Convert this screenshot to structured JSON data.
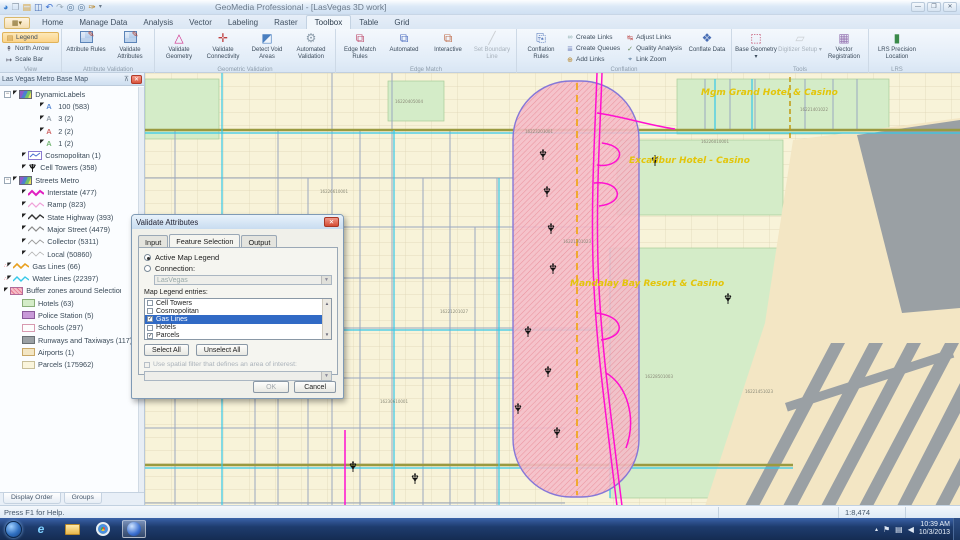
{
  "window": {
    "title": "GeoMedia Professional - [LasVegas 3D work]"
  },
  "ribbon": {
    "tabs": [
      "Home",
      "Manage Data",
      "Analysis",
      "Vector",
      "Labeling",
      "Raster",
      "Toolbox",
      "Table",
      "Grid"
    ],
    "active_tab": "Toolbox",
    "view": {
      "label": "View",
      "buttons": [
        "Legend",
        "North Arrow",
        "Scale Bar"
      ]
    },
    "attr_validation": {
      "label": "Attribute Validation",
      "buttons": [
        "Attribute Rules",
        "Validate Attributes"
      ]
    },
    "geom_validation": {
      "label": "Geometric Validation",
      "buttons": [
        "Validate Geometry",
        "Validate Connectivity",
        "Detect Void Areas",
        "Automated Validation"
      ]
    },
    "edge_match": {
      "label": "Edge Match",
      "buttons": [
        "Edge Match Rules",
        "Automated",
        "Interactive",
        "Set Boundary Line"
      ]
    },
    "conflation": {
      "label": "Conflation",
      "large": "Conflation Rules",
      "small": [
        "Create Links",
        "Create Queues",
        "Add Links",
        "Adjust Links",
        "Quality Analysis",
        "Link Zoom"
      ],
      "conflate": "Conflate Data"
    },
    "tools": {
      "label": "Tools",
      "buttons": [
        "Base Geometry",
        "Digitizer Setup",
        "Vector Registration"
      ]
    },
    "lrs": {
      "label": "LRS",
      "buttons": [
        "LRS Precision Location"
      ]
    }
  },
  "legend": {
    "title": "Las Vegas Metro Base Map",
    "items": [
      {
        "icon": "dynamiclabels-map-icon",
        "label": "DynamicLabels",
        "count": ""
      },
      {
        "icon": "label-a-blue-icon",
        "label": "100",
        "count": "(583)"
      },
      {
        "icon": "label-a-gray-icon",
        "label": "3",
        "count": "(2)"
      },
      {
        "icon": "label-a-red-icon",
        "label": "2",
        "count": "(2)"
      },
      {
        "icon": "label-a-green-icon",
        "label": "1",
        "count": "(2)"
      },
      {
        "icon": "cosmopolitan-swatch-icon",
        "label": "Cosmopolitan",
        "count": "(1)"
      },
      {
        "icon": "cell-tower-icon",
        "label": "Cell Towers",
        "count": "(358)"
      },
      {
        "icon": "streets-map-icon",
        "label": "Streets Metro",
        "count": ""
      },
      {
        "icon": "interstate-line-icon",
        "label": "Interstate",
        "count": "(477)"
      },
      {
        "icon": "ramp-line-icon",
        "label": "Ramp",
        "count": "(823)"
      },
      {
        "icon": "state-highway-line-icon",
        "label": "State Highway",
        "count": "(393)"
      },
      {
        "icon": "major-street-line-icon",
        "label": "Major Street",
        "count": "(4479)"
      },
      {
        "icon": "collector-line-icon",
        "label": "Collector",
        "count": "(5311)"
      },
      {
        "icon": "local-line-icon",
        "label": "Local",
        "count": "(50860)"
      },
      {
        "icon": "gas-line-icon",
        "label": "Gas Lines",
        "count": "(66)"
      },
      {
        "icon": "water-line-icon",
        "label": "Water Lines",
        "count": "(22397)"
      },
      {
        "icon": "buffer-swatch-icon",
        "label": "Buffer zones around Selection of gas li",
        "count": ""
      },
      {
        "icon": "hotels-swatch-icon",
        "label": "Hotels",
        "count": "(63)"
      },
      {
        "icon": "police-swatch-icon",
        "label": "Police Station",
        "count": "(5)"
      },
      {
        "icon": "schools-swatch-icon",
        "label": "Schools",
        "count": "(297)"
      },
      {
        "icon": "runways-swatch-icon",
        "label": "Runways and Taxiways",
        "count": "(117)"
      },
      {
        "icon": "airports-swatch-icon",
        "label": "Airports",
        "count": "(1)"
      },
      {
        "icon": "parcels-swatch-icon",
        "label": "Parcels",
        "count": "(175962)"
      }
    ],
    "tabs": [
      "Display Order",
      "Groups"
    ]
  },
  "dialog": {
    "title": "Validate Attributes",
    "tabs": [
      "Input",
      "Feature Selection",
      "Output"
    ],
    "active_tab": "Feature Selection",
    "radio_active_map_legend": "Active Map Legend",
    "radio_connection": "Connection:",
    "connection_value": "LasVegas",
    "list_label": "Map Legend entries:",
    "entries": [
      {
        "label": "Cell Towers",
        "mark": ""
      },
      {
        "label": "Cosmopolitan",
        "mark": ""
      },
      {
        "label": "Gas Lines",
        "mark": "✓"
      },
      {
        "label": "Hotels",
        "mark": ""
      },
      {
        "label": "Parcels",
        "mark": "✓"
      },
      {
        "label": "Police Station",
        "mark": ""
      }
    ],
    "select_all": "Select All",
    "unselect_all": "Unselect All",
    "spatial_filter": "Use spatial filter that defines an area of interest:",
    "ok": "OK",
    "cancel": "Cancel"
  },
  "map": {
    "casino_labels": [
      "Mgm Grand Hotel & Casino",
      "Excalibur Hotel - Casino",
      "Mandalay Bay Resort & Casino"
    ],
    "parcel_labels": [
      "16220405004",
      "16226010001",
      "16221301023",
      "16221201027",
      "16226610001",
      "16228501003",
      "16221401022",
      "16221451023",
      "16230610001",
      "16223203001"
    ],
    "colors": {
      "buffer_fill": "#f4bcc8",
      "buffer_edge": "#8577d8",
      "interstate": "#ff10d0",
      "water": "#35c8e8",
      "gas": "#f0a820",
      "casino_label": "#e3c50a"
    }
  },
  "status": {
    "help": "Press F1 for Help.",
    "scale": "1:8,474"
  },
  "taskbar": {
    "time": "10:39 AM",
    "date": "10/3/2013"
  }
}
